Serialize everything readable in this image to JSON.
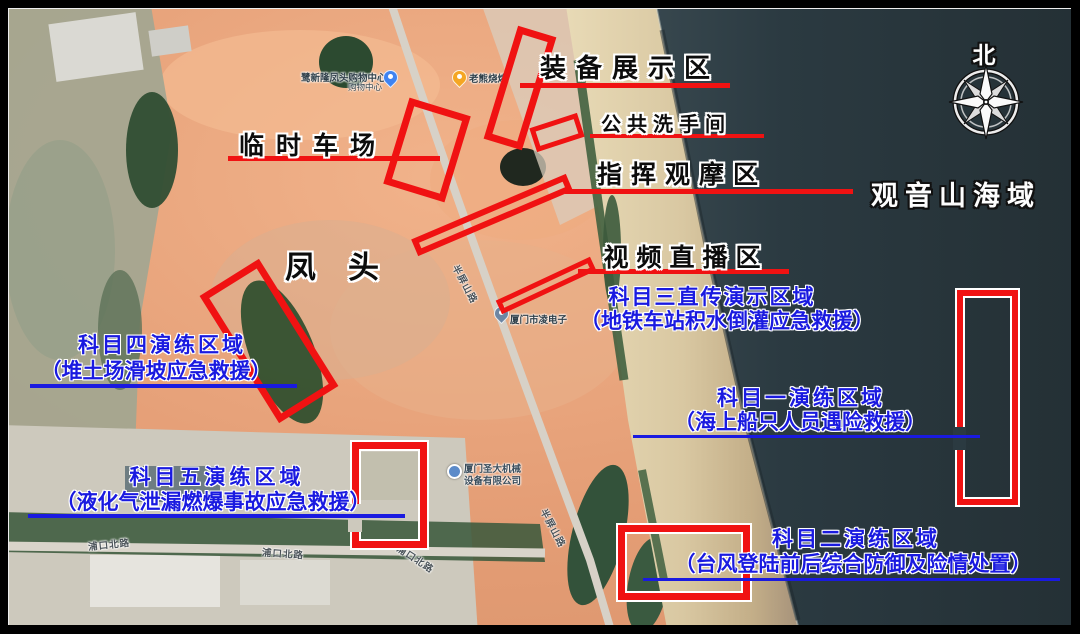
{
  "places": {
    "sea_area": "观音山海域",
    "fengtou": "凤头",
    "north": "北"
  },
  "facilities": {
    "equipment": {
      "label": "装备展示区"
    },
    "restroom": {
      "label": "公共洗手间"
    },
    "command": {
      "label": "指挥观摩区"
    },
    "parking": {
      "label": "临时车场"
    },
    "video_live": {
      "label": "视频直播区"
    }
  },
  "subjects": {
    "subject3": {
      "name": "科目三直传演示区域",
      "detail": "（地铁车站积水倒灌应急救援）"
    },
    "subject4": {
      "name": "科目四演练区域",
      "detail": "（堆土场滑坡应急救援）"
    },
    "subject1": {
      "name": "科目一演练区域",
      "detail": "（海上船只人员遇险救援）"
    },
    "subject5": {
      "name": "科目五演练区域",
      "detail": "（液化气泄漏燃爆事故应急救援）"
    },
    "subject2": {
      "name": "科目二演练区域",
      "detail": "（台风登陆前后综合防御及险情处置）"
    }
  },
  "pois": {
    "shopping_center": {
      "name": "鹭新隆凤头购物中心",
      "category": "购物中心"
    },
    "bbq": {
      "name": "老熊烧烤"
    },
    "electronics": {
      "name": "厦门市凌电子"
    },
    "machinery": {
      "name_line1": "厦门圣大机械",
      "name_line2": "设备有限公司"
    }
  },
  "roads": {
    "banpingshan": "半屏山路",
    "pukoubei": "浦口北路"
  },
  "colors": {
    "zone_red": "#f01212",
    "subject_blue": "#1a1ae0",
    "sea": "#2b3a41",
    "beach_sand": "#d9c8a2",
    "land_dirt": "#e49d75"
  }
}
